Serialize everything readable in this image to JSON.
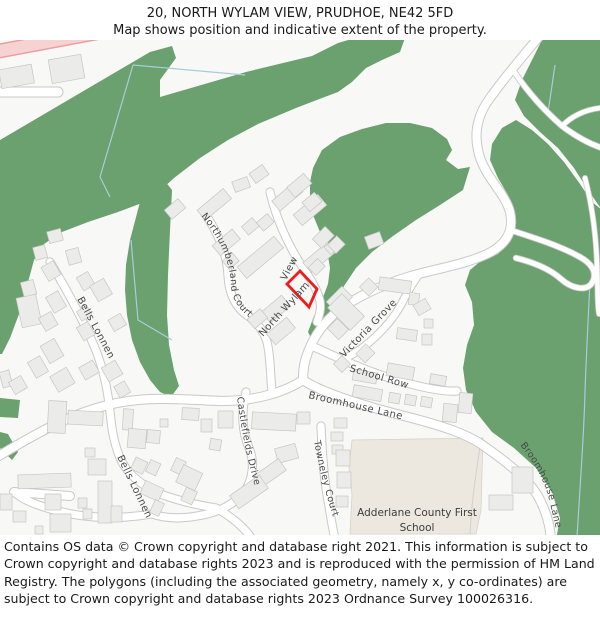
{
  "title": {
    "line1": "20, NORTH WYLAM VIEW, PRUDHOE, NE42 5FD",
    "line2": "Map shows position and indicative extent of the property."
  },
  "street_labels": {
    "northumberland_court": "Northumberland Court",
    "north_wylam": "North Wylam",
    "view": "View",
    "victoria_grove": "Victoria Grove",
    "school_row": "School Row",
    "broomhouse_lane_1": "Broomhouse Lane",
    "broomhouse_lane_2": "Broomhouse Lane",
    "bells_lonnen_1": "Bells Lonnen",
    "bells_lonnen_2": "Bells Lonnen",
    "castlefields_drive": "Castlefields Drive",
    "towneley_court": "Towneley Court"
  },
  "poi": {
    "school_line1": "Adderlane County First",
    "school_line2": "School"
  },
  "footer": {
    "text": "Contains OS data © Crown copyright and database right 2021. This information is subject to Crown copyright and database rights 2023 and is reproduced with the permission of HM Land Registry. The polygons (including the associated geometry, namely x, y co-ordinates) are subject to Crown copyright and database rights 2023 Ordnance Survey 100026316."
  },
  "colors": {
    "woodland": "#6ba06f",
    "road_fill": "#ffffff",
    "road_casing": "#c9c9c9",
    "building_fill": "#ebebe9",
    "building_stroke": "#c6c6c4",
    "plot_outline": "#ef1c1c",
    "school_grounds": "#ece8e0",
    "primary_road": "#f6d2d2",
    "primary_road_casing": "#e8a0a0",
    "water": "#a8cdd8",
    "label": "#4a4a4a",
    "background": "#f8f8f6"
  }
}
